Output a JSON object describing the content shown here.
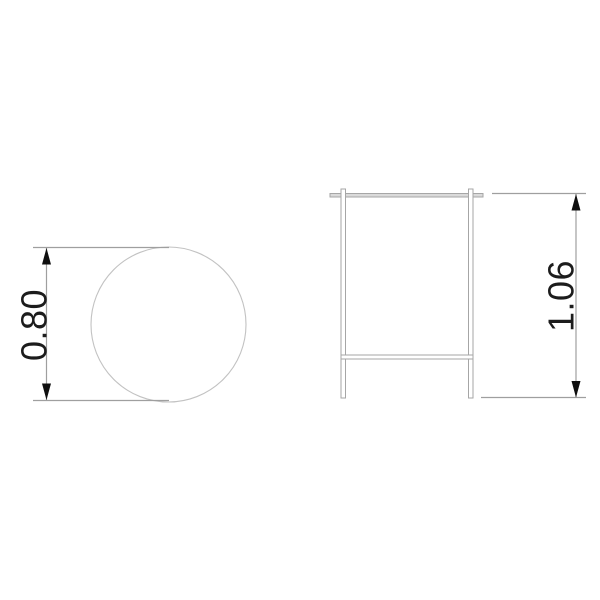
{
  "drawing": {
    "background": "#ffffff",
    "top_view": {
      "shape": "circle",
      "dimension_label": "0.80",
      "dimension_axis": "vertical",
      "measures": "tabletop diameter"
    },
    "front_view": {
      "shape": "table-frame-with-two-legs-and-stretcher",
      "dimension_label": "1.06",
      "dimension_axis": "vertical",
      "measures": "overall height"
    },
    "colors": {
      "outline_gray": "#a6a6a6",
      "circle_gray": "#c2c2c2",
      "dimension_gray": "#9f9f9f",
      "tabletop_fill": "#dadada",
      "ink": "#1c1c1c",
      "arrow": "#0f0f0f"
    }
  }
}
